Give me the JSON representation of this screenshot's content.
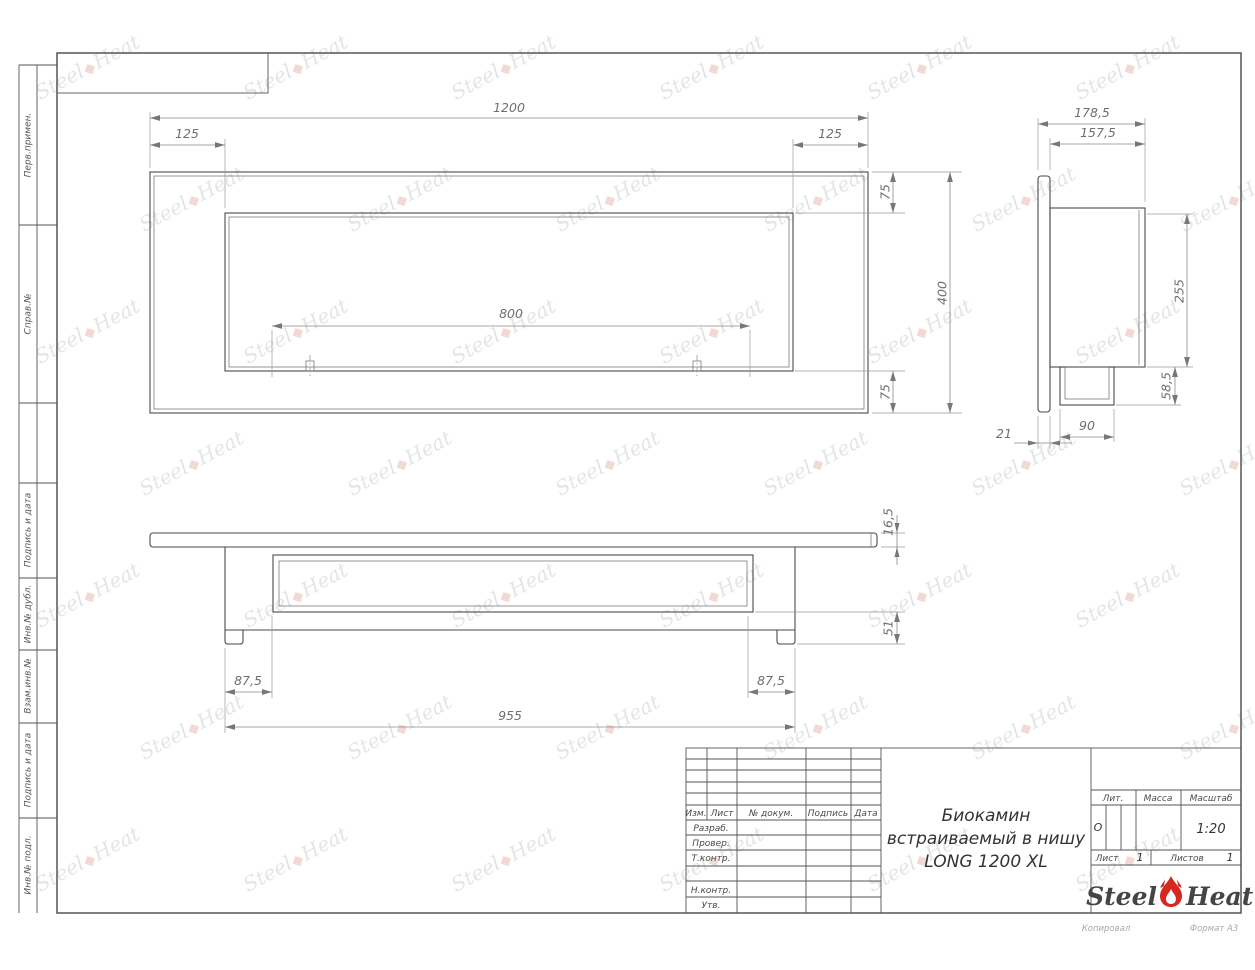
{
  "doc": {
    "title_line1": "Биокамин",
    "title_line2": "встраиваемый в нишу",
    "title_line3": "LONG 1200 XL"
  },
  "dims": {
    "front_width": "1200",
    "front_inset_left": "125",
    "front_inset_right": "125",
    "front_opening": "800",
    "front_top_offset": "75",
    "front_height": "400",
    "front_bottom_offset": "75",
    "side_depth_total": "178,5",
    "side_depth_body": "157,5",
    "side_body_height": "255",
    "side_bottom_offset": "58,5",
    "side_flange_depth": "21",
    "side_burner_width": "90",
    "bottom_plate_thickness": "16,5",
    "bottom_base_height": "51",
    "bottom_inset_left": "87,5",
    "bottom_body_width": "955",
    "bottom_inset_right": "87,5"
  },
  "margin": {
    "col1": "Перв.примен.",
    "col2": "Справ.№",
    "col3": "Подпись и дата",
    "col4": "Инв.№ дубл.",
    "col5": "Взам.инв.№",
    "col6": "Подпись и дата",
    "col7": "Инв.№ подл."
  },
  "title_block": {
    "izm": "Изм.",
    "list": "Лист",
    "doc_num": "№ докум.",
    "podpis": "Подпись",
    "data": "Дата",
    "razrab": "Разраб.",
    "prover": "Провер.",
    "tkontr": "Т.контр.",
    "nkontr": "Н.контр.",
    "utv": "Утв.",
    "lit_label": "Лит.",
    "lit_value": "О",
    "massa_label": "Масса",
    "scale_label": "Масштаб",
    "scale_value": "1:20",
    "list_label": "Лист",
    "list_value": "1",
    "listov_label": "Листов",
    "listov_value": "1"
  },
  "logo": {
    "word1": "Steel",
    "word2": "Heat"
  },
  "footer": {
    "copied": "Копировал",
    "format": "Формат А3"
  },
  "watermark": {
    "word1": "Steel",
    "word2": "Heat",
    "flame": "◆"
  },
  "colors": {
    "flame_red": "#d6281e",
    "line": "#3c3c3c",
    "dim": "#8a8a8a",
    "watermark": "#ccd2c8"
  }
}
